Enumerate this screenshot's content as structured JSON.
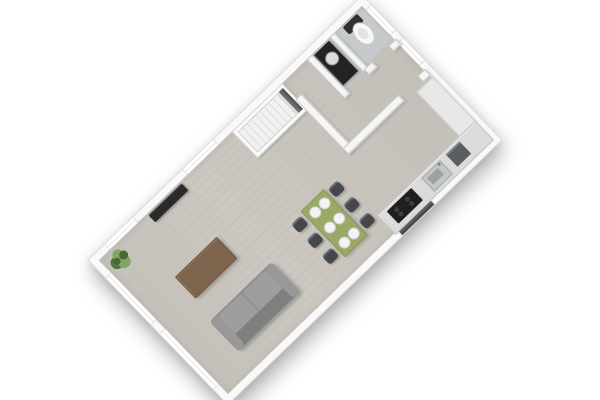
{
  "scene": {
    "description": "3D top-down architectural floor plan render of an apartment, rotated on a white background",
    "rotation_deg": -44,
    "visible_text": "none"
  },
  "colors": {
    "background": "#ffffff",
    "outer_wall": "#f9f9f9",
    "wall_edge": "#dddddd",
    "floor": "#ccc8c1",
    "floor_stripe": "#c4c0b9",
    "wc_floor": "#c7cacb",
    "window": "#ffffff",
    "stairs_tread_a": "#f1f1f1",
    "stairs_tread_b": "#dbdbdb",
    "sofa": "#909090",
    "sofa_back": "#7f7f7f",
    "sofa_cushion": "#9e9e9e",
    "coffee_table": "#7e634d",
    "dining_table": "#9ba966",
    "plate": "#f3f3f3",
    "chair": "#45484b",
    "counter": "#dbdbdb",
    "cooktop": "#1f1f1f",
    "sink": "#c4c7c8",
    "appliance": "#5b5e60",
    "cabinet": "#e8e8e8",
    "toilet": "#f7f7f7",
    "toilet_lid": "#2e3032",
    "vanity": "#232323",
    "tv": "#2a2a2a",
    "plant_dark": "#4b6636",
    "plant_mid": "#55743f",
    "plant_light": "#82a763"
  },
  "rooms": [
    {
      "id": "living-room",
      "features": [
        "two windows on long upper wall",
        "two tall windows on short left wall",
        "tv sideboard",
        "corner plant",
        "sofa",
        "coffee table",
        "dining area"
      ]
    },
    {
      "id": "kitchen",
      "features": [
        "counter along lower wall",
        "cooktop",
        "sink",
        "oven",
        "tall cabinet",
        "dark window"
      ]
    },
    {
      "id": "hall",
      "features": [
        "front door",
        "sidelight window",
        "stair access"
      ]
    },
    {
      "id": "wc",
      "features": [
        "toilet",
        "dark vanity with round basin"
      ]
    },
    {
      "id": "staircase",
      "features": [
        "straight flight",
        "approx 11 treads",
        "dark entry gap"
      ]
    }
  ],
  "furniture_counts": {
    "dining_chairs": 6,
    "place_settings": 6,
    "sofa_seats": 2,
    "windows_total": 6,
    "doors_exterior": 1
  }
}
